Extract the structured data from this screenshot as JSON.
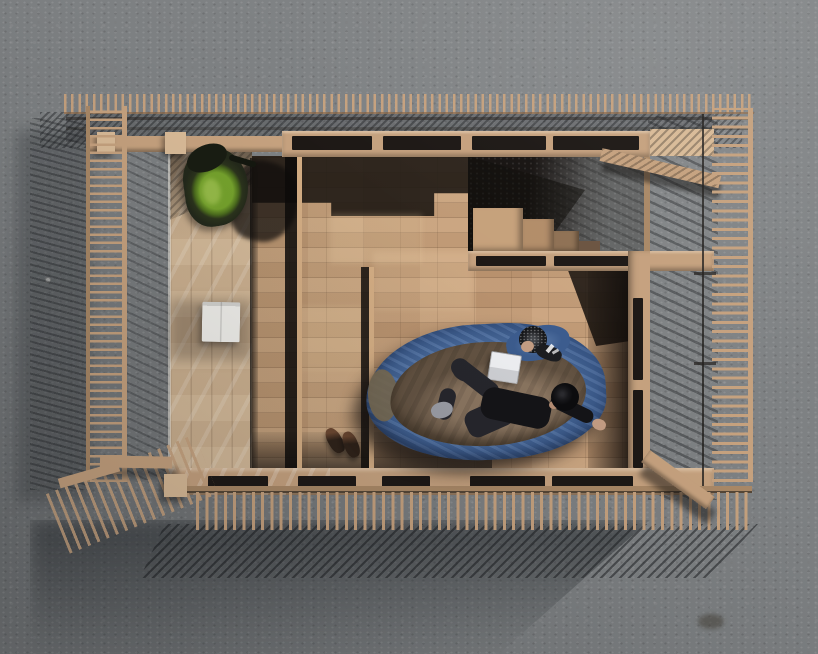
{
  "scene": {
    "description": "Aerial top-down architectural render of a small timber pavilion with slatted pergola fences on a concrete ground; two people rest inside on a blue sleeping bag with an open laptop, a green backpack, an open white book and a pair of boots on the wooden parquet floor; low sun from the upper right casts long comb-like slat shadows to the lower left.",
    "view": "top-down aerial",
    "people_count": 2,
    "objects": [
      {
        "name": "timber-pavilion"
      },
      {
        "name": "slatted-pergola-fence-north"
      },
      {
        "name": "slatted-pergola-fence-west"
      },
      {
        "name": "slatted-pergola-fence-east"
      },
      {
        "name": "slatted-pergola-fence-south"
      },
      {
        "name": "glass-roof-porch"
      },
      {
        "name": "wooden-parquet-floor"
      },
      {
        "name": "wall-with-slot-openings"
      },
      {
        "name": "wooden-steps"
      },
      {
        "name": "green-backpack"
      },
      {
        "name": "open-white-book"
      },
      {
        "name": "pair-of-boots"
      },
      {
        "name": "blue-sleeping-bag"
      },
      {
        "name": "brown-duvet"
      },
      {
        "name": "white-laptop"
      },
      {
        "name": "person-in-beanie-inside-sleeping-bag"
      },
      {
        "name": "person-lying-in-black-clothes"
      },
      {
        "name": "corner-benches"
      },
      {
        "name": "cast-slat-shadows"
      }
    ]
  },
  "palette": {
    "concrete": "#7d8082",
    "concrete_light": "#8e9193",
    "concrete_dark": "#63666a",
    "wood": "#c5a17e",
    "wood_light": "#d8ba97",
    "wood_dark": "#a98866",
    "floor": "#c49c77",
    "glass_wood": "#cfb493",
    "interior_dark": "#1d1815",
    "bag_blue": "#5377ab",
    "bag_blue_dark": "#3c5c8e",
    "duvet": "#8a7560",
    "skin": "#c49d83",
    "cloth_black": "#141417",
    "jeans": "#26262c",
    "sock": "#9b9da5",
    "pack_green": "#74a12c",
    "pack_dark": "#23281a",
    "paper": "#edece8",
    "laptop": "#eff0f3",
    "boot": "#2e2118",
    "boot_top": "#6b4730"
  }
}
